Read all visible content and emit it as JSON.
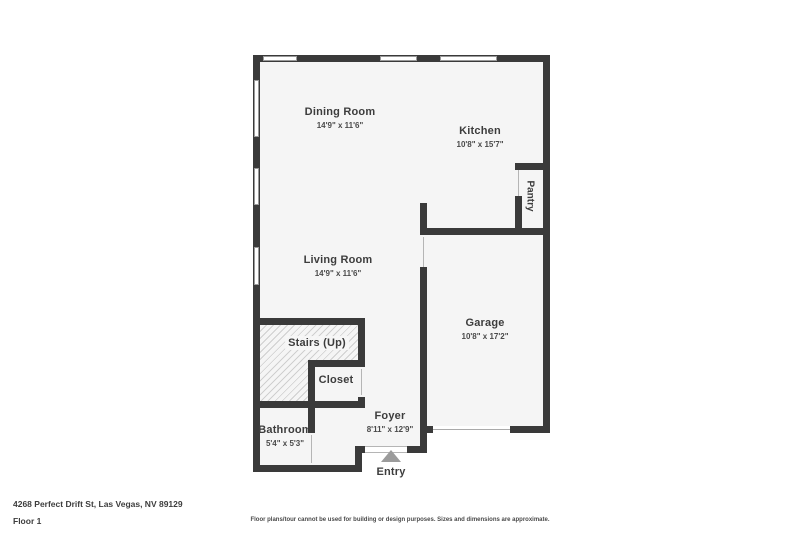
{
  "address": "4268 Perfect Drift St, Las Vegas, NV 89129",
  "floor_label": "Floor 1",
  "disclaimer": "Floor plans/tour cannot be used for building or design purposes. Sizes and dimensions are approximate.",
  "entry_label": "Entry",
  "rooms": {
    "dining": {
      "name": "Dining Room",
      "dims": "14'9\" x 11'6\""
    },
    "kitchen": {
      "name": "Kitchen",
      "dims": "10'8\" x 15'7\""
    },
    "pantry": {
      "name": "Pantry"
    },
    "living": {
      "name": "Living Room",
      "dims": "14'9\" x 11'6\""
    },
    "garage": {
      "name": "Garage",
      "dims": "10'8\" x 17'2\""
    },
    "stairs": {
      "name": "Stairs (Up)"
    },
    "closet": {
      "name": "Closet"
    },
    "bathroom": {
      "name": "Bathroom",
      "dims": "5'4\" x 5'3\""
    },
    "foyer": {
      "name": "Foyer",
      "dims": "8'11\" x 12'9\""
    }
  },
  "colors": {
    "wall": "#3a3a3a",
    "room_fill": "#f5f5f5",
    "text": "#3d3d3d",
    "entry_arrow": "#9b9b9b",
    "background": "#ffffff"
  }
}
